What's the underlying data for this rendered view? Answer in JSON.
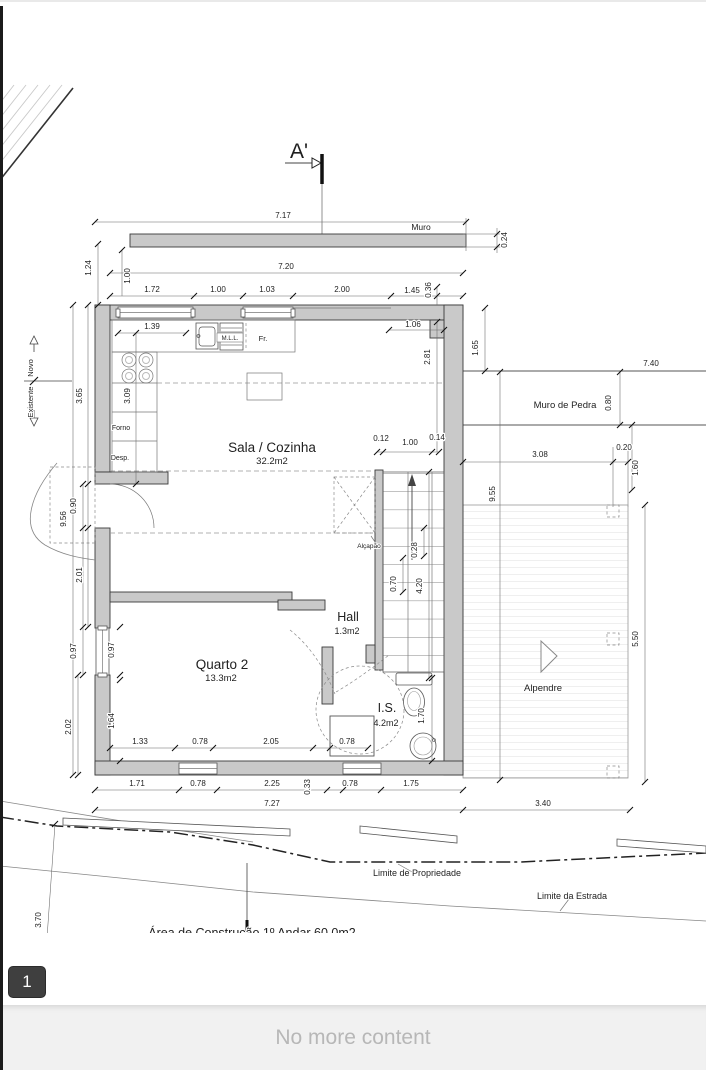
{
  "viewer": {
    "page_badge": "1",
    "footer_text": "No more content"
  },
  "colors": {
    "wall_fill": "#c9c9c9",
    "badge_bg": "#3f3f3f",
    "footer_bg": "#f1f1f1",
    "footer_text_color": "#b7b7b7"
  },
  "plan": {
    "section_label": "A'",
    "rooms": {
      "sala": {
        "name": "Sala / Cozinha",
        "area": "32.2m2"
      },
      "quarto2": {
        "name": "Quarto 2",
        "area": "13.3m2"
      },
      "hall": {
        "name": "Hall",
        "area": "1.3m2"
      },
      "is": {
        "name": "I.S.",
        "area": "4.2m2"
      },
      "alpendre": {
        "name": "Alpendre",
        "area": ""
      }
    },
    "annotations": [
      {
        "t": "Muro",
        "x": 421,
        "y": 230,
        "s": 8.5
      },
      {
        "t": "Muro de Pedra",
        "x": 565,
        "y": 408,
        "s": 9.5
      },
      {
        "t": "Alçapão",
        "x": 369,
        "y": 548,
        "s": 6.5,
        "a": "end"
      },
      {
        "t": "Forno",
        "x": 121,
        "y": 430,
        "s": 7,
        "a": "start"
      },
      {
        "t": "Desp.",
        "x": 120,
        "y": 460,
        "s": 7,
        "a": "start"
      },
      {
        "t": "M.L.L.",
        "x": 230,
        "y": 340,
        "s": 6
      },
      {
        "t": "Fr.",
        "x": 263,
        "y": 341,
        "s": 7.5
      },
      {
        "t": "Novo",
        "x": 33,
        "y": 368,
        "s": 7.5,
        "r": 1
      },
      {
        "t": "Existente",
        "x": 33,
        "y": 402,
        "s": 7.5,
        "r": 1
      },
      {
        "t": "Limite de Propriedade",
        "x": 417,
        "y": 876,
        "s": 9,
        "a": "start"
      },
      {
        "t": "Limite da Estrada",
        "x": 572,
        "y": 899,
        "s": 9,
        "a": "start"
      },
      {
        "t": "Área de Construção  1º Andar  60.0m2",
        "x": 252,
        "y": 937,
        "s": 12.5,
        "a": "start"
      }
    ],
    "dimensions": [
      {
        "t": "7.17",
        "x": 283,
        "y": 218
      },
      {
        "t": "0.24",
        "x": 507,
        "y": 240,
        "r": 1
      },
      {
        "t": "7.20",
        "x": 286,
        "y": 269
      },
      {
        "t": "1.00",
        "x": 130,
        "y": 276,
        "r": 1
      },
      {
        "t": "1.72",
        "x": 152,
        "y": 292
      },
      {
        "t": "1.00",
        "x": 218,
        "y": 292
      },
      {
        "t": "1.03",
        "x": 267,
        "y": 292
      },
      {
        "t": "2.00",
        "x": 342,
        "y": 292
      },
      {
        "t": "1.45",
        "x": 412,
        "y": 293
      },
      {
        "t": "0.36",
        "x": 431,
        "y": 290,
        "r": 1
      },
      {
        "t": "1.39",
        "x": 152,
        "y": 329
      },
      {
        "t": "1.06",
        "x": 413,
        "y": 327
      },
      {
        "t": "1.65",
        "x": 478,
        "y": 348,
        "r": 1
      },
      {
        "t": "2.81",
        "x": 430,
        "y": 357,
        "r": 1
      },
      {
        "t": "3.09",
        "x": 130,
        "y": 396,
        "r": 1
      },
      {
        "t": "1.24",
        "x": 91,
        "y": 268,
        "r": 1
      },
      {
        "t": "3.65",
        "x": 82,
        "y": 396,
        "r": 1
      },
      {
        "t": "0.90",
        "x": 76,
        "y": 506,
        "r": 1
      },
      {
        "t": "9.56",
        "x": 66,
        "y": 519,
        "r": 1
      },
      {
        "t": "2.01",
        "x": 82,
        "y": 575,
        "r": 1
      },
      {
        "t": "0.97",
        "x": 76,
        "y": 651,
        "r": 1
      },
      {
        "t": "2.02",
        "x": 71,
        "y": 727,
        "r": 1
      },
      {
        "t": "0.97",
        "x": 114,
        "y": 650,
        "r": 1
      },
      {
        "t": "1.64",
        "x": 114,
        "y": 721,
        "r": 1
      },
      {
        "t": "0.12",
        "x": 381,
        "y": 441
      },
      {
        "t": "1.00",
        "x": 410,
        "y": 445
      },
      {
        "t": "0.14",
        "x": 437,
        "y": 440
      },
      {
        "t": "0.28",
        "x": 417,
        "y": 550,
        "r": 1
      },
      {
        "t": "0.70",
        "x": 396,
        "y": 584,
        "r": 1
      },
      {
        "t": "4.20",
        "x": 422,
        "y": 586,
        "r": 1
      },
      {
        "t": "9.55",
        "x": 495,
        "y": 494,
        "r": 1
      },
      {
        "t": "7.40",
        "x": 651,
        "y": 366
      },
      {
        "t": "0.80",
        "x": 611,
        "y": 403,
        "r": 1
      },
      {
        "t": "3.08",
        "x": 540,
        "y": 457
      },
      {
        "t": "0.20",
        "x": 624,
        "y": 450
      },
      {
        "t": "1.60",
        "x": 638,
        "y": 468,
        "r": 1
      },
      {
        "t": "5.50",
        "x": 638,
        "y": 639,
        "r": 1
      },
      {
        "t": "1.33",
        "x": 140,
        "y": 744
      },
      {
        "t": "0.78",
        "x": 200,
        "y": 744
      },
      {
        "t": "2.05",
        "x": 271,
        "y": 744
      },
      {
        "t": "0.78",
        "x": 347,
        "y": 744
      },
      {
        "t": "1.70",
        "x": 424,
        "y": 716,
        "r": 1
      },
      {
        "t": "1.71",
        "x": 137,
        "y": 786
      },
      {
        "t": "0.78",
        "x": 198,
        "y": 786
      },
      {
        "t": "2.25",
        "x": 272,
        "y": 786
      },
      {
        "t": "0.33",
        "x": 310,
        "y": 787,
        "r": 1
      },
      {
        "t": "0.78",
        "x": 350,
        "y": 786
      },
      {
        "t": "1.75",
        "x": 411,
        "y": 786
      },
      {
        "t": "7.27",
        "x": 272,
        "y": 806
      },
      {
        "t": "3.40",
        "x": 543,
        "y": 806
      },
      {
        "t": "3.70",
        "x": 41,
        "y": 920,
        "r": 1
      }
    ]
  }
}
